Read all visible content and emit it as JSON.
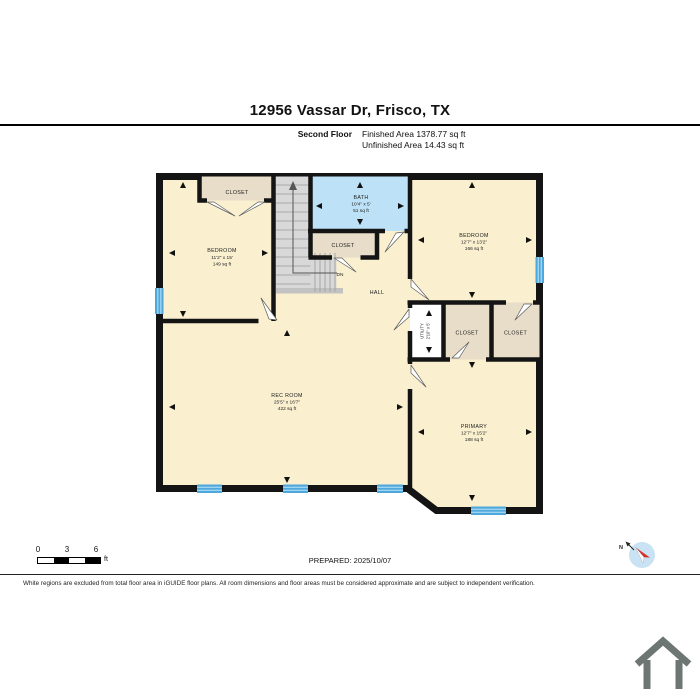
{
  "header": {
    "title": "12956 Vassar Dr, Frisco, TX",
    "floor_label": "Second Floor",
    "finished": "Finished Area 1378.77 sq ft",
    "unfinished": "Unfinished Area 14.43 sq ft"
  },
  "plan": {
    "rooms": {
      "closet_tl": {
        "name": "CLOSET"
      },
      "bedroom_left": {
        "name": "BEDROOM",
        "dims": "11'2\" x 15'",
        "area": "149 sq ft"
      },
      "bath": {
        "name": "BATH",
        "dims": "10'4\" x 5'",
        "area": "51 sq ft"
      },
      "closet_hall": {
        "name": "CLOSET"
      },
      "bedroom_right": {
        "name": "BEDROOM",
        "dims": "12'7\" x 13'2\"",
        "area": "166 sq ft"
      },
      "hall": {
        "name": "HALL"
      },
      "stairs": {
        "down_label": "DN"
      },
      "utility": {
        "name": "UTILITY",
        "dims": "2'10\" x 5'"
      },
      "closet_mid_left": {
        "name": "CLOSET"
      },
      "closet_mid_right": {
        "name": "CLOSET"
      },
      "rec_room": {
        "name": "REC ROOM",
        "dims": "25'5\" x 16'7\"",
        "area": "422 sq ft"
      },
      "primary": {
        "name": "PRIMARY",
        "dims": "12'7\" x 15'2\"",
        "area": "188 sq ft"
      }
    },
    "colors": {
      "wall": "#141414",
      "room_fill": "#FAF0D0",
      "closet_fill": "#E8DDC9",
      "bath_fill": "#BDE2F7",
      "stairs_fill": "#D8D8D8",
      "landing_fill": "#C2C2C2",
      "window_fill": "#4FA8DC",
      "unfinished_fill": "#FFFFFF",
      "compass_bg": "#C9E3F5",
      "compass_needle": "#D73027",
      "house_icon": "#6D7673"
    }
  },
  "footer": {
    "scale": {
      "t0": "0",
      "t1": "3",
      "t2": "6",
      "unit": "ft"
    },
    "prepared": "PREPARED: 2025/10/07",
    "compass_label": "N",
    "disclaimer": "White regions are excluded from total floor area in iGUIDE floor plans. All room dimensions and floor areas must be considered approximate and are subject to independent verification."
  }
}
